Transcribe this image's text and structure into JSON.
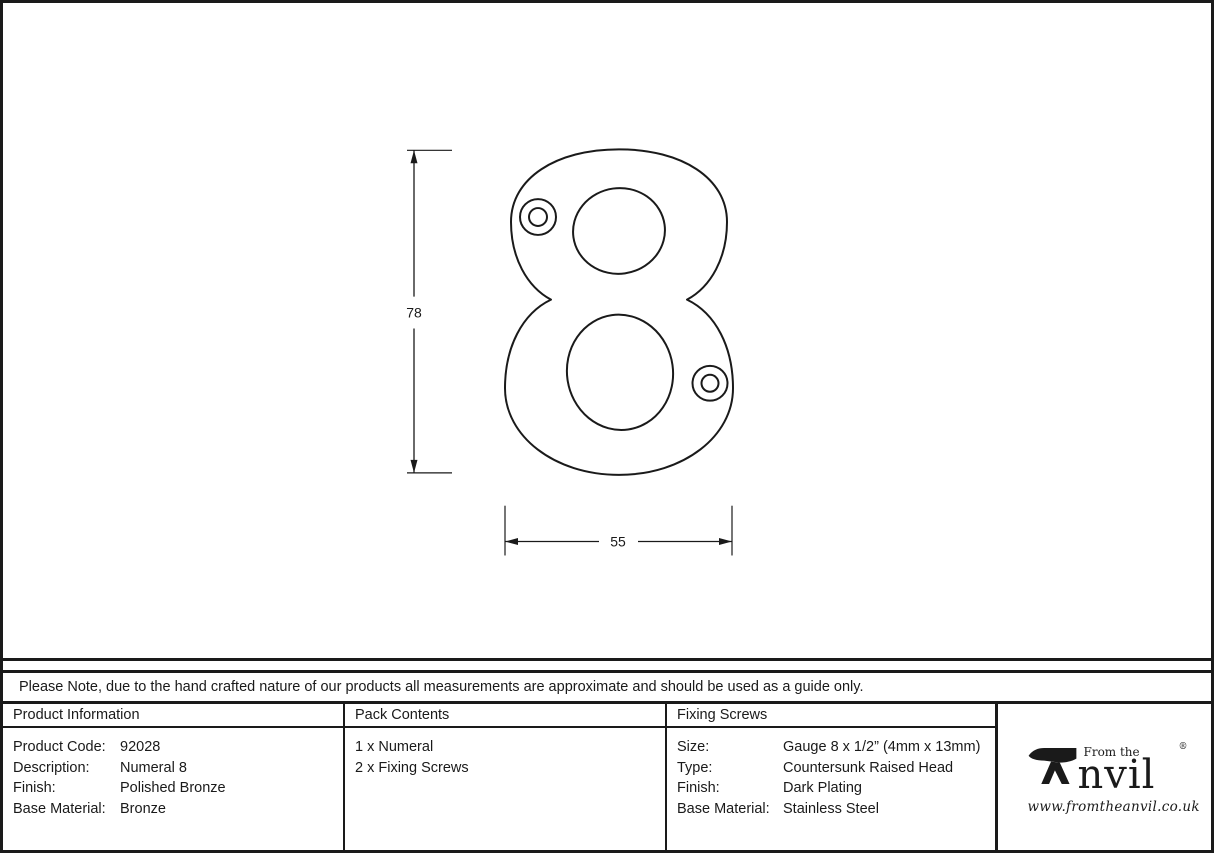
{
  "page": {
    "note": "Please Note, due to the hand crafted nature of our products all measurements are approximate and should be used as a guide only."
  },
  "drawing": {
    "numeral": "8",
    "height_label": "78",
    "width_label": "55"
  },
  "table": {
    "product_information": {
      "header": "Product Information",
      "rows": [
        {
          "label": "Product Code:",
          "value": "92028"
        },
        {
          "label": "Description:",
          "value": "Numeral 8"
        },
        {
          "label": "Finish:",
          "value": "Polished Bronze"
        },
        {
          "label": "Base Material:",
          "value": "Bronze"
        }
      ]
    },
    "pack_contents": {
      "header": "Pack Contents",
      "items": [
        "1 x Numeral",
        "2 x Fixing Screws"
      ]
    },
    "fixing_screws": {
      "header": "Fixing Screws",
      "rows": [
        {
          "label": "Size:",
          "value": "Gauge 8 x 1/2” (4mm x 13mm)"
        },
        {
          "label": "Type:",
          "value": "Countersunk Raised Head"
        },
        {
          "label": "Finish:",
          "value": "Dark Plating"
        },
        {
          "label": "Base Material:",
          "value": "Stainless Steel"
        }
      ]
    }
  },
  "logo": {
    "tagline": "From the",
    "brand": "Anvil",
    "brand_rest": "nvil",
    "registered": "®",
    "url": "www.fromtheanvil.co.uk"
  },
  "colors": {
    "line": "#1a1a1a",
    "background": "#ffffff"
  }
}
